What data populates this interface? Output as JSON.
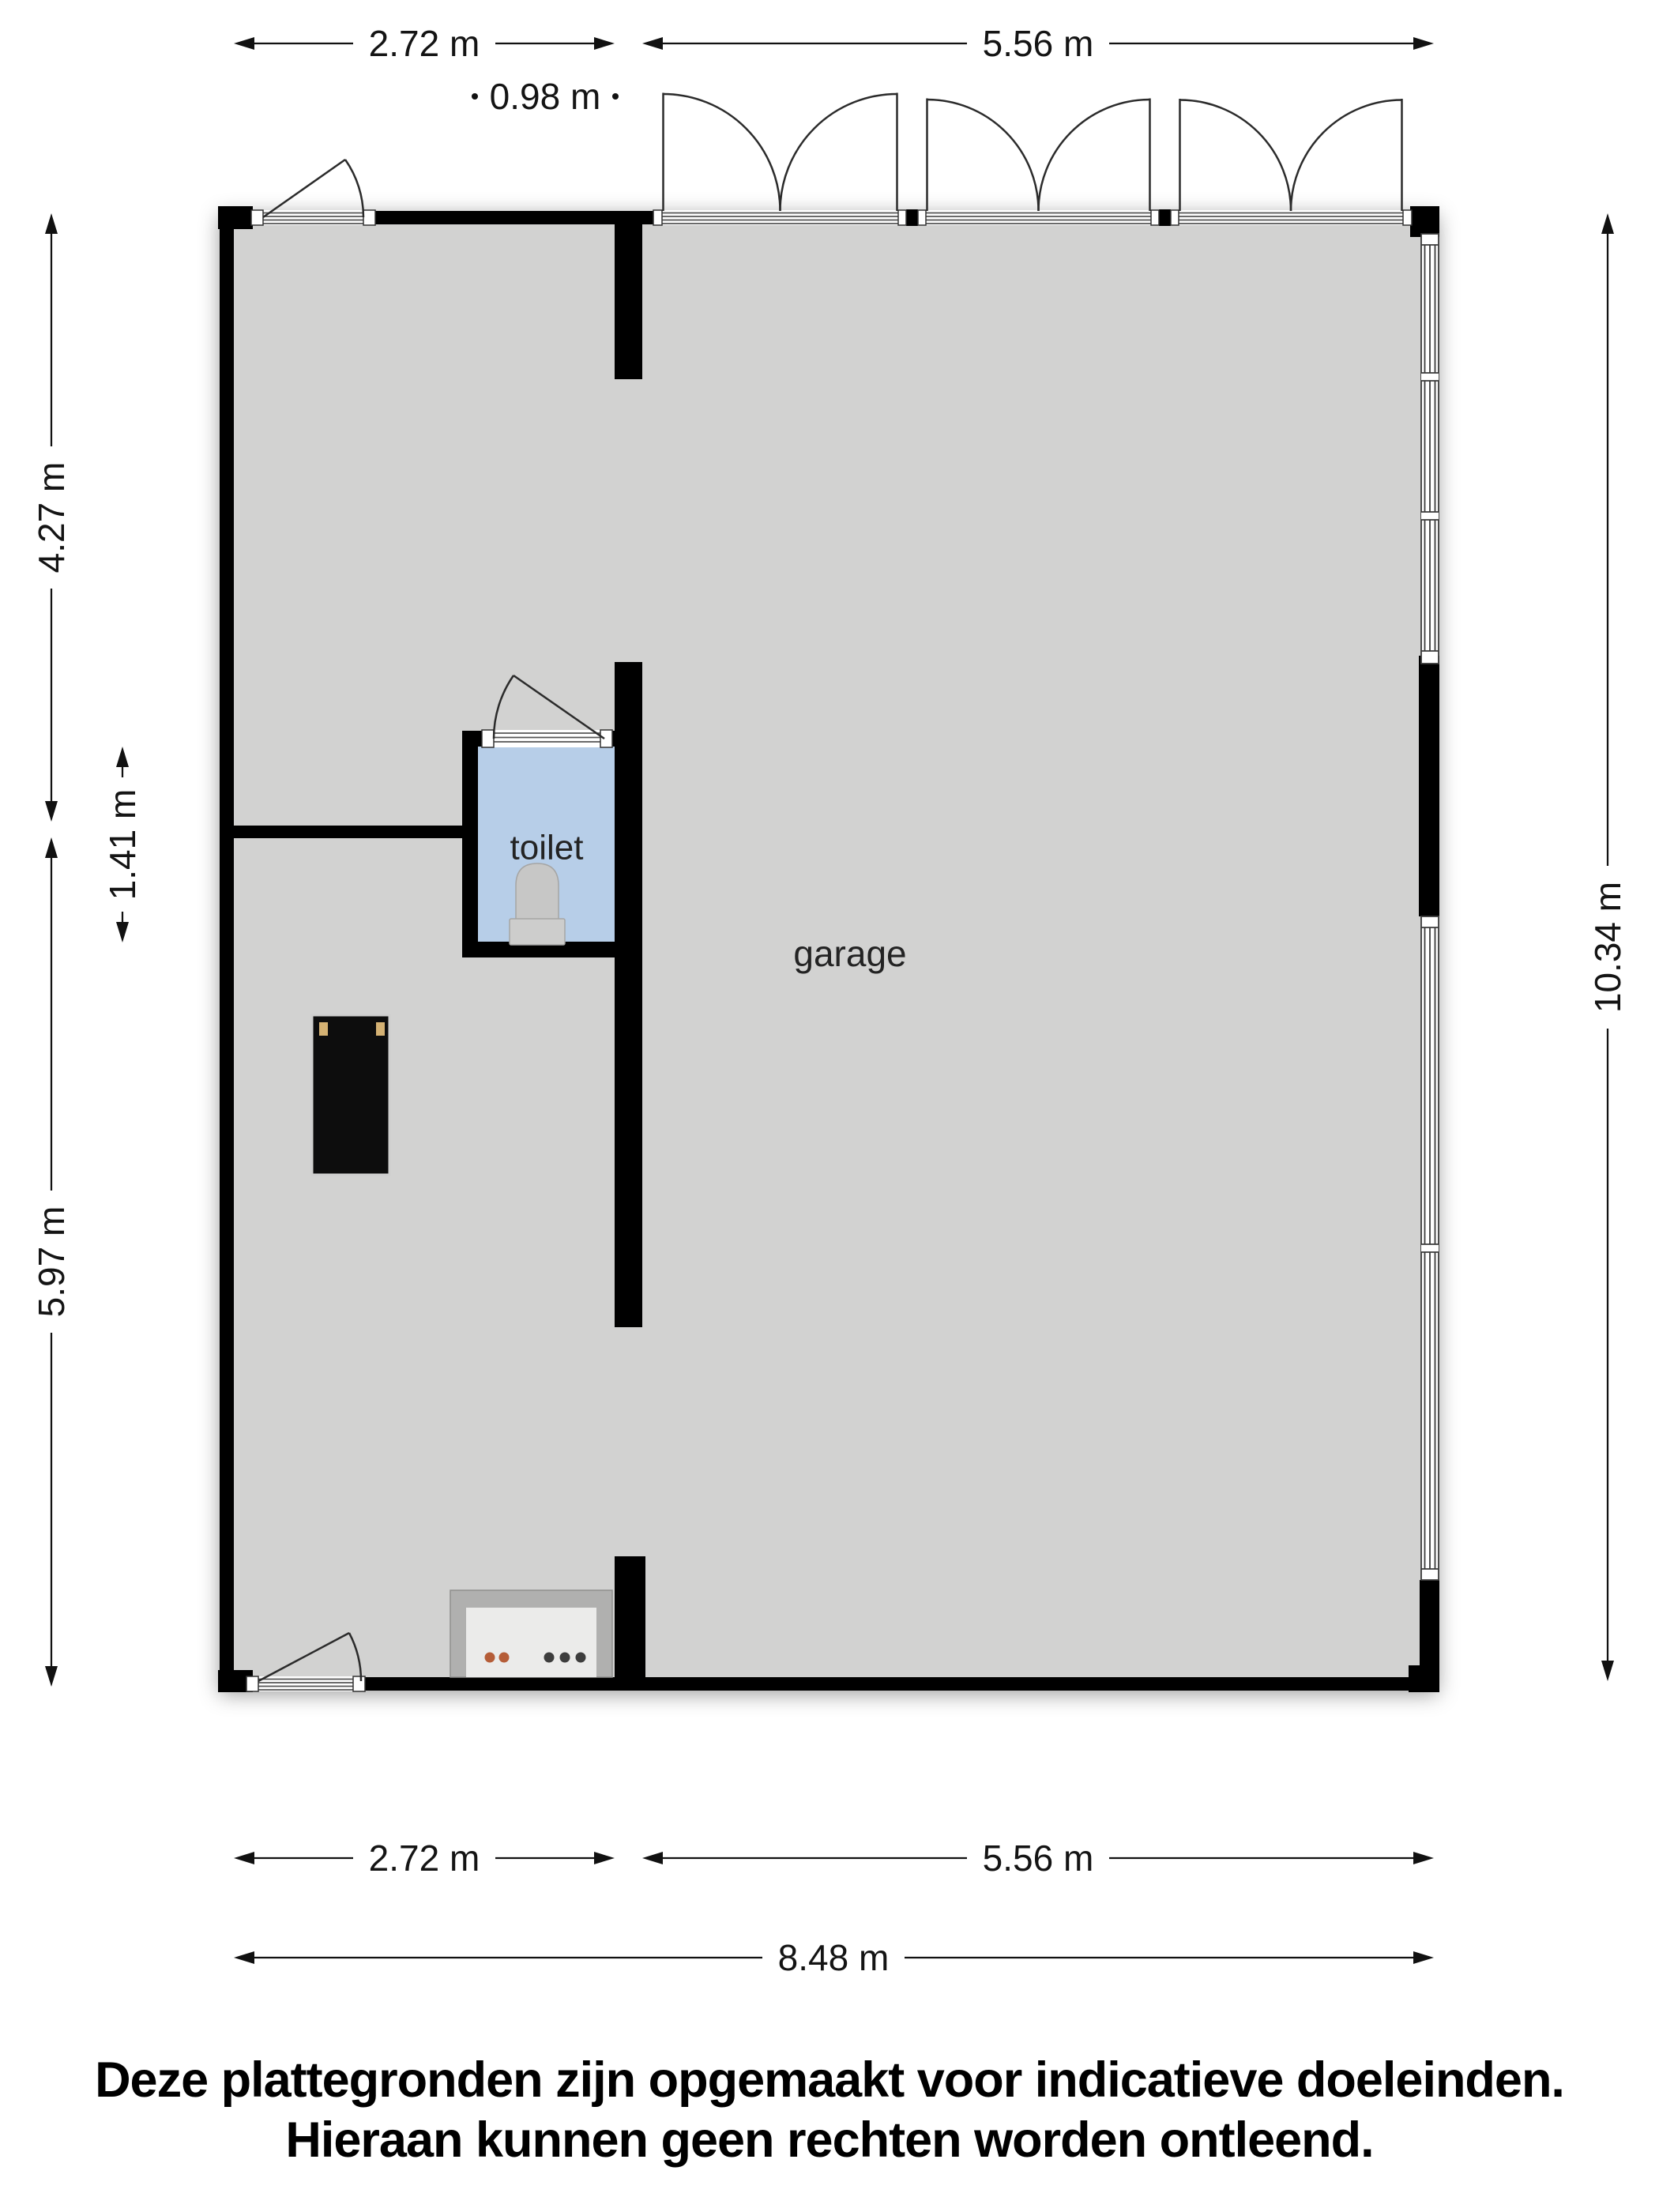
{
  "plan": {
    "rooms": {
      "toilet": "toilet",
      "garage": "garage"
    },
    "dimensions": {
      "top": [
        "2.72 m",
        "5.56 m"
      ],
      "top_small": "0.98 m",
      "left": [
        "4.27 m",
        "1.41 m",
        "5.97 m"
      ],
      "right": "10.34 m",
      "bottom": [
        "2.72 m",
        "5.56 m",
        "8.48 m"
      ]
    },
    "colors": {
      "wall": "#000000",
      "floor": "#d2d2d1",
      "toilet_floor": "#b7cee8",
      "stove_knob_orange": "#b55d38",
      "stove_knob_dark": "#3d3d3d",
      "cabinet_handle_tan": "#d4b173"
    }
  },
  "disclaimer": {
    "line1": "Deze plattegronden zijn opgemaakt voor indicatieve doeleinden.",
    "line2": "Hieraan kunnen geen rechten worden ontleend."
  }
}
